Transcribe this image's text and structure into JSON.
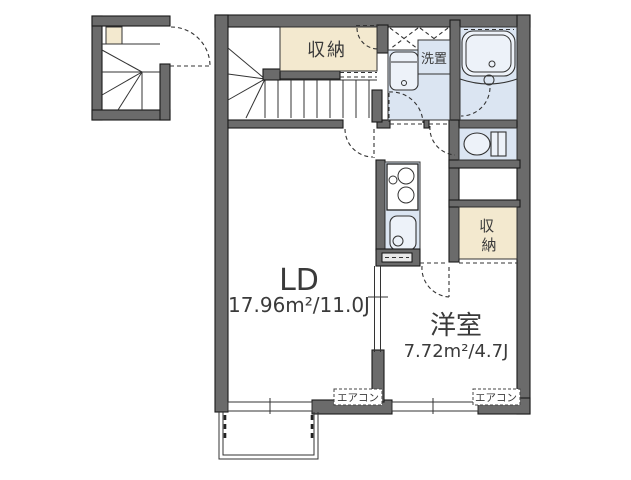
{
  "plan": {
    "rooms": {
      "ld": {
        "name": "LD",
        "area": "17.96m²/11.0J"
      },
      "western": {
        "name": "洋室",
        "area": "7.72m²/4.7J"
      }
    },
    "labels": {
      "storage_top": "収納",
      "laundry": "洗置",
      "storage_right_char1": "収",
      "storage_right_char2": "納",
      "aircon_ld": "エアコン",
      "aircon_western": "エアコン"
    },
    "colors": {
      "wall": "#6b6b6b",
      "outline": "#1a1a1a",
      "storage_fill": "#f3e9cf",
      "wet_area_fill": "#dbe5f2",
      "fixture_fill": "#edf2f9",
      "label_text": "#3a3a3a",
      "background": "#ffffff"
    }
  }
}
